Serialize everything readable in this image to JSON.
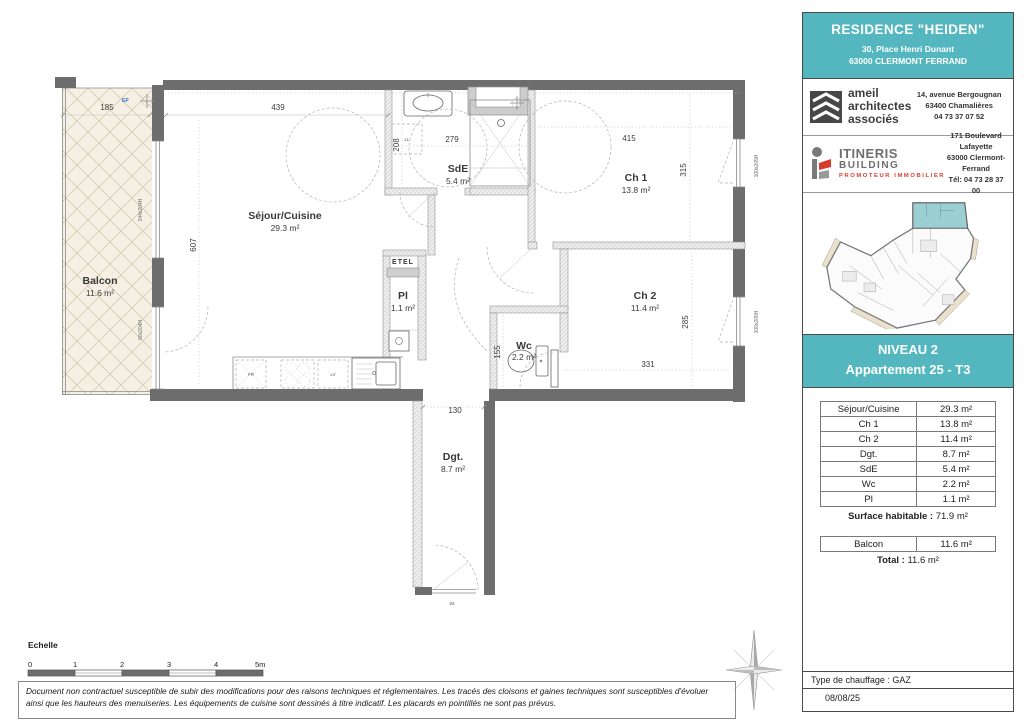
{
  "header": {
    "title": "RESIDENCE \"HEIDEN\"",
    "address_line1": "30, Place Henri Dunant",
    "address_line2": "63000 CLERMONT FERRAND"
  },
  "architect": {
    "name_line1": "ameil",
    "name_line2": "architectes",
    "name_line3": "associés",
    "address_line1": "14, avenue Bergougnan",
    "address_line2": "63400 Chamalières",
    "phone": "04 73 37 07 52"
  },
  "promoter": {
    "name_line1": "ITINERIS",
    "name_line2": "BUILDING",
    "tagline": "PROMOTEUR IMMOBILIER",
    "address_line1": "171 Boulevard Lafayette",
    "address_line2": "63000 Clermont-Ferrand",
    "phone": "Tél: 04 73 28 37 00"
  },
  "level": {
    "line1": "NIVEAU 2",
    "line2": "Appartement 25 - T3"
  },
  "table": {
    "rows": [
      [
        "Séjour/Cuisine",
        "29.3 m²"
      ],
      [
        "Ch 1",
        "13.8 m²"
      ],
      [
        "Ch 2",
        "11.4 m²"
      ],
      [
        "Dgt.",
        "8.7 m²"
      ],
      [
        "SdE",
        "5.4 m²"
      ],
      [
        "Wc",
        "2.2 m²"
      ],
      [
        "Pl",
        "1.1 m²"
      ]
    ],
    "surface_label": "Surface habitable :",
    "surface_value": "71.9 m²",
    "balcony_label": "Balcon",
    "balcony_value": "11.6 m²",
    "total_label": "Total :",
    "total_value": "11.6 m²"
  },
  "plan": {
    "rooms": {
      "balcon": {
        "name": "Balcon",
        "area": "11.6 m²"
      },
      "sejour": {
        "name": "Séjour/Cuisine",
        "area": "29.3 m²"
      },
      "sde": {
        "name": "SdE",
        "area": "5.4 m²"
      },
      "ch1": {
        "name": "Ch 1",
        "area": "13.8 m²"
      },
      "ch2": {
        "name": "Ch 2",
        "area": "11.4 m²"
      },
      "wc": {
        "name": "Wc",
        "area": "2.2 m²"
      },
      "pl": {
        "name": "Pl",
        "area": "1.1 m²"
      },
      "dgt": {
        "name": "Dgt.",
        "area": "8.7 m²"
      },
      "etel": {
        "name": "ETEL"
      }
    },
    "dims": {
      "balcon_w": "185",
      "sejour_w": "439",
      "sde_w": "279",
      "sde_d": "208",
      "ch1_w": "415",
      "ch1_d": "315",
      "sejour_d": "607",
      "ch2_d": "285",
      "ch2_w": "331",
      "wc_d": "155",
      "dgt_w": "130",
      "entry_w": "93"
    },
    "labels": {
      "fridge": "FR",
      "dishwasher": "LV",
      "washer": "LL",
      "ep": "EP"
    },
    "windows": {
      "w1": "244x204H",
      "w2": "90x204H",
      "w3": "100x205H",
      "w4": "100x205H"
    }
  },
  "scale": {
    "label": "Echelle",
    "ticks": [
      "0",
      "1",
      "2",
      "3",
      "4",
      "5m"
    ]
  },
  "footer": {
    "heating": "Type de chauffage : GAZ",
    "date": "08/08/25",
    "disclaimer1": "Document non contractuel susceptible de subir des modifications pour des raisons techniques et réglementaires. Les tracés des cloisons et gaines techniques sont susceptibles d'évoluer",
    "disclaimer2": "ainsi que les hauteurs des menuiseries. Les équipements de cuisine sont dessinés à titre indicatif. Les placards en pointillés ne sont pas prévus."
  },
  "colors": {
    "teal": "#54b7bf",
    "wall": "#6d6d6d",
    "balcony_fill": "#f4f1e4",
    "accent_red": "#d93a2b"
  }
}
